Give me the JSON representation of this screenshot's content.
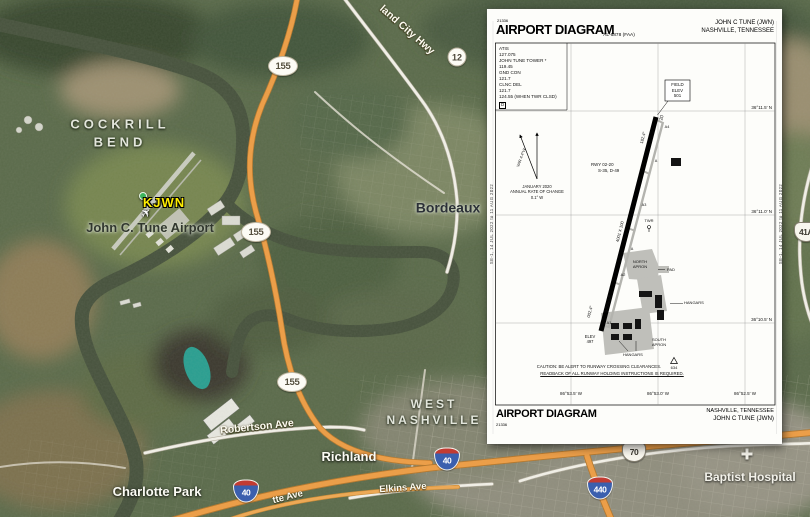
{
  "theme": {
    "map-base": "#5a6a4a",
    "river": "#46513c",
    "road-orange": "#ef9d43",
    "road-white": "#f4f2ea",
    "label-yellow": "#ffee00",
    "sheet-bg": "#fdfdfa"
  },
  "map": {
    "labels": [
      {
        "id": "label-cockrill-bend",
        "cls": "area",
        "x": 120,
        "y": 133,
        "lines": [
          "COCKRILL",
          "BEND"
        ],
        "clickable": false
      },
      {
        "id": "label-west-nashville",
        "cls": "area sm",
        "x": 434,
        "y": 412,
        "lines": [
          "WEST",
          "NASHVILLE"
        ],
        "clickable": false
      },
      {
        "id": "label-bordeaux",
        "cls": "city",
        "x": 448,
        "y": 208,
        "lines": [
          "Bordeaux"
        ],
        "clickable": false
      },
      {
        "id": "label-john-c-tune-airport",
        "cls": "poi-dark",
        "x": 150,
        "y": 228,
        "lines": [
          "John C. Tune Airport"
        ],
        "clickable": true
      },
      {
        "id": "label-kjwn",
        "cls": "wp",
        "x": 164,
        "y": 203,
        "lines": [
          "KJWN"
        ],
        "clickable": true
      },
      {
        "id": "label-richland",
        "cls": "town",
        "x": 349,
        "y": 457,
        "lines": [
          "Richland"
        ],
        "clickable": false
      },
      {
        "id": "label-charlotte-park",
        "cls": "town",
        "x": 157,
        "y": 492,
        "lines": [
          "Charlotte Park"
        ],
        "clickable": false
      },
      {
        "id": "label-baptist-hospital",
        "cls": "poi-white",
        "x": 750,
        "y": 477,
        "lines": [
          "Baptist Hospital"
        ],
        "clickable": true
      },
      {
        "id": "label-ashland-city-hwy",
        "cls": "roadlbl",
        "x": 407,
        "y": 30,
        "rot": 41,
        "lines": [
          "land City Hwy"
        ],
        "clickable": false
      },
      {
        "id": "label-robertson-ave",
        "cls": "roadlbl",
        "x": 257,
        "y": 427,
        "rot": -6,
        "lines": [
          "Robertson Ave"
        ],
        "clickable": false
      },
      {
        "id": "label-elkins-ave",
        "cls": "roadlbl sm",
        "x": 403,
        "y": 489,
        "rot": -4,
        "lines": [
          "Elkins Ave"
        ],
        "clickable": false
      },
      {
        "id": "label-charlotte-ave",
        "cls": "roadlbl sm",
        "x": 288,
        "y": 498,
        "rot": -14,
        "lines": [
          "tte Ave"
        ],
        "clickable": false
      }
    ],
    "shields": [
      {
        "id": "tn155-north",
        "type": "tn-oval",
        "text": "155",
        "x": 283,
        "y": 66
      },
      {
        "id": "tn155-mid",
        "type": "tn-oval",
        "text": "155",
        "x": 256,
        "y": 232
      },
      {
        "id": "tn155-south",
        "type": "tn-oval",
        "text": "155",
        "x": 292,
        "y": 382
      },
      {
        "id": "tn12",
        "type": "circle",
        "text": "12",
        "x": 457,
        "y": 57
      },
      {
        "id": "i40-west",
        "type": "interstate",
        "text": "40",
        "x": 246,
        "y": 491
      },
      {
        "id": "i40-east",
        "type": "interstate",
        "text": "40",
        "x": 447,
        "y": 459
      },
      {
        "id": "i440",
        "type": "interstate",
        "text": "440",
        "x": 600,
        "y": 488
      },
      {
        "id": "us70",
        "type": "us",
        "text": "70",
        "x": 634,
        "y": 452
      },
      {
        "id": "us41a",
        "type": "us",
        "text": "41A",
        "x": 806,
        "y": 232
      }
    ]
  },
  "diagram": {
    "header": {
      "doc_number": "21336",
      "title": "AIRPORT DIAGRAM",
      "al_number": "AL-6878 (FAA)",
      "airport": "JOHN C TUNE (JWN)",
      "city": "NASHVILLE, TENNESSEE"
    },
    "footer": {
      "title": "AIRPORT DIAGRAM",
      "doc_number": "21336",
      "city": "NASHVILLE, TENNESSEE",
      "airport": "JOHN C TUNE (JWN)"
    },
    "edge_note": "SE-1, 14 JUL 2022 to 11 AUG 2022",
    "annotations": [
      {
        "id": "comm-freqs",
        "t": "ATIS\n127.075\nJOHN TUNE TOWER *\n119.45\nGND CON\n121.7\nCLNC DEL\n121.7\n124.55 (WHEN TWR CLSD)",
        "x": 12,
        "y": 37,
        "s": 4.6
      },
      {
        "id": "clnc-d-box",
        "t": "D",
        "x": 12,
        "y": 93,
        "s": 4.4,
        "cls": "boxd"
      },
      {
        "id": "field-elev",
        "t": "FIELD\nELEV\n501",
        "x": 190.5,
        "y": 73,
        "s": 4.4,
        "a": "c"
      },
      {
        "id": "var-arrow-label",
        "t": "VAR 4.4°W",
        "x": 34,
        "y": 146,
        "s": 3.9,
        "a": "c",
        "r": -70
      },
      {
        "id": "mag-var-note",
        "t": "JANUARY 2020\nANNUAL RATE OF CHANGE\n0.1° W",
        "x": 50,
        "y": 175,
        "s": 4.1,
        "a": "c"
      },
      {
        "id": "rwy-data",
        "t": "RWY 02-20\nS-35, D-49",
        "x": 104,
        "y": 153,
        "s": 4.4,
        "cls": "ind"
      },
      {
        "id": "rwy20-number",
        "t": "20",
        "x": 176,
        "y": 106,
        "s": 4.8,
        "a": "c",
        "r": -76
      },
      {
        "id": "rwy20-heading",
        "t": "182.4°",
        "x": 156,
        "y": 126,
        "s": 4.2,
        "a": "c",
        "r": -76
      },
      {
        "id": "rwy-dimensions",
        "t": "4001 X 100",
        "x": 133,
        "y": 220,
        "s": 4.2,
        "a": "c",
        "r": -76
      },
      {
        "id": "rwy-slope",
        "t": "0.75% UP",
        "x": 121,
        "y": 292,
        "s": 4,
        "a": "c",
        "r": -76
      },
      {
        "id": "rwy02-heading",
        "t": "002.4°",
        "x": 103,
        "y": 300,
        "s": 4.2,
        "a": "c",
        "r": -76
      },
      {
        "id": "rwy02-elev",
        "t": "ELEV\n497",
        "x": 103,
        "y": 325,
        "s": 4.1,
        "a": "c"
      },
      {
        "id": "twy-a4",
        "t": "A4",
        "x": 180,
        "y": 116,
        "s": 3.8,
        "a": "c",
        "cls": "twy"
      },
      {
        "id": "twy-a-upper",
        "t": "A",
        "x": 169,
        "y": 150,
        "s": 3.8,
        "a": "c",
        "cls": "twy"
      },
      {
        "id": "twy-a3",
        "t": "A3",
        "x": 157,
        "y": 194,
        "s": 3.8,
        "a": "c",
        "cls": "twy"
      },
      {
        "id": "twy-a-lower",
        "t": "A",
        "x": 145,
        "y": 238,
        "s": 3.8,
        "a": "c",
        "cls": "twy"
      },
      {
        "id": "twy-a2",
        "t": "A2",
        "x": 136,
        "y": 264,
        "s": 3.8,
        "a": "c",
        "cls": "twy"
      },
      {
        "id": "twy-a1",
        "t": "A1",
        "x": 122,
        "y": 312,
        "s": 3.8,
        "a": "c",
        "cls": "twy"
      },
      {
        "id": "twr-label",
        "t": "TWR",
        "x": 162,
        "y": 209,
        "s": 4,
        "a": "c"
      },
      {
        "id": "north-apron",
        "t": "NORTH\nAPRON",
        "x": 153,
        "y": 250,
        "s": 4,
        "a": "c"
      },
      {
        "id": "pad-label",
        "t": "PAD",
        "x": 180,
        "y": 258,
        "s": 4
      },
      {
        "id": "hangars-east",
        "t": "HANGARS",
        "x": 197,
        "y": 291,
        "s": 4
      },
      {
        "id": "south-apron",
        "t": "SOUTH\nAPRON",
        "x": 172,
        "y": 328,
        "s": 4,
        "a": "c"
      },
      {
        "id": "hangars-south",
        "t": "HANGARS",
        "x": 136,
        "y": 343,
        "s": 4
      },
      {
        "id": "obstruction-634",
        "t": "634",
        "x": 187,
        "y": 356,
        "s": 4,
        "a": "c"
      },
      {
        "id": "caution-line1",
        "t": "CAUTION: BE ALERT TO RUNWAY CROSSING CLEARANCES.",
        "x": 112,
        "y": 355,
        "s": 4.3,
        "a": "c"
      },
      {
        "id": "caution-line2",
        "t": "READBACK OF ALL RUNWAY HOLDING INSTRUCTIONS IS REQUIRED.",
        "x": 125,
        "y": 362,
        "s": 4.3,
        "a": "c",
        "u": true
      },
      {
        "id": "lat-36-11-5",
        "t": "36°11.5' N",
        "x": 285,
        "y": 96,
        "s": 4.5,
        "a": "r"
      },
      {
        "id": "lat-36-11-0",
        "t": "36°11.0' N",
        "x": 285,
        "y": 200,
        "s": 4.5,
        "a": "r"
      },
      {
        "id": "lat-36-10-5",
        "t": "36°10.5' N",
        "x": 285,
        "y": 308,
        "s": 4.5,
        "a": "r"
      },
      {
        "id": "lon-86-53-5",
        "t": "86°53.5' W",
        "x": 84,
        "y": 382,
        "s": 4.5,
        "a": "c"
      },
      {
        "id": "lon-86-53-0",
        "t": "86°53.0' W",
        "x": 171,
        "y": 382,
        "s": 4.5,
        "a": "c"
      },
      {
        "id": "lon-86-52-5",
        "t": "86°52.5' W",
        "x": 258,
        "y": 382,
        "s": 4.5,
        "a": "c"
      }
    ]
  }
}
